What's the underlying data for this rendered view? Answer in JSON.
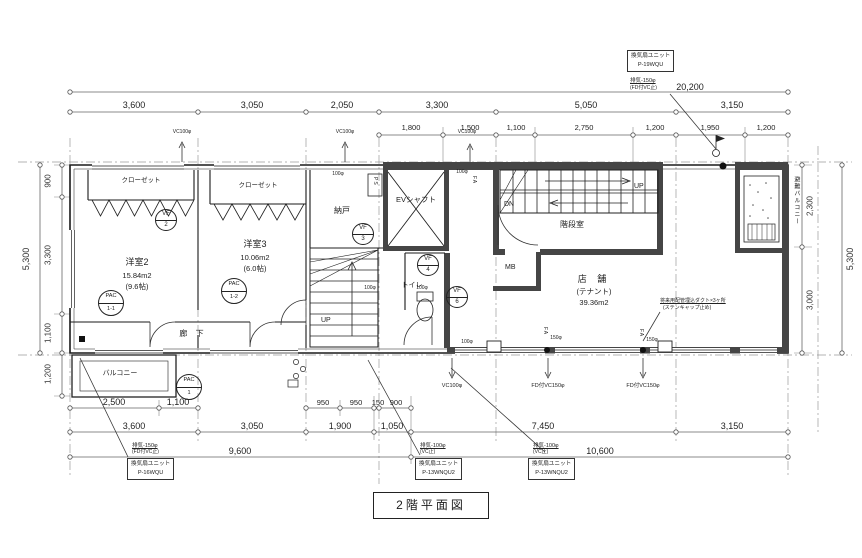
{
  "title": "2階平面図",
  "dims": {
    "top_total": "20,200",
    "top_main": [
      "3,600",
      "3,050",
      "2,050",
      "3,300",
      "5,050",
      "3,150"
    ],
    "top_sub": [
      "1,800",
      "1,500",
      "1,100",
      "2,750",
      "1,200",
      "1,950",
      "1,200"
    ],
    "left_total": "5,300",
    "left_segs": [
      "900",
      "3,300",
      "1,100"
    ],
    "left_below": "1,200",
    "right_total": "5,300",
    "right_segs": [
      "2,300",
      "3,000"
    ],
    "bottom_row1_left": [
      "2,500",
      "1,100"
    ],
    "bottom_row1_mid": [
      "950",
      "950",
      "150",
      "900"
    ],
    "bottom_row2": [
      "3,600",
      "3,050",
      "1,900",
      "1,050",
      "7,450",
      "3,150"
    ],
    "bottom_row3": [
      "9,600",
      "10,600"
    ]
  },
  "rooms": {
    "yoshitsu2": {
      "name": "洋室2",
      "area": "15.84m2",
      "tatami": "(9.6帖)"
    },
    "yoshitsu3": {
      "name": "洋室3",
      "area": "10.06m2",
      "tatami": "(6.0帖)"
    },
    "tenant": {
      "name": "店 舗",
      "sub": "(テナント)",
      "area": "39.36m2"
    },
    "nando": "納戸",
    "ev_shaft": "EVシャフト",
    "toilet": "トイレ",
    "stair_hall": "階段室",
    "corridor": "廊 下",
    "balcony": "バルコニー",
    "evac_balcony": "避難バルコニー",
    "closet1": "クローゼット",
    "closet2": "クローゼット"
  },
  "symbols": {
    "vf2": {
      "t": "VF",
      "n": "2"
    },
    "vf3": {
      "t": "VF",
      "n": "3"
    },
    "vf4": {
      "t": "VF",
      "n": "4"
    },
    "vf6": {
      "t": "VF",
      "n": "6"
    },
    "pac11": {
      "t": "PAC",
      "n": "1-1"
    },
    "pac12": {
      "t": "PAC",
      "n": "1-2"
    },
    "pac1": {
      "t": "PAC",
      "n": "1"
    },
    "mb": "MB",
    "ps": "PS",
    "up1": "UP",
    "up2": "UP",
    "dn": "DN"
  },
  "pipes": {
    "vc100_top1": "VC100φ",
    "vc100_top2": "VC100φ",
    "vc100_top3": "VC100φ",
    "vc100_bottom": "VC100φ",
    "fdvc150_1": "FD付VC150φ",
    "fdvc150_2": "FD付VC150φ",
    "d100_1": "100φ",
    "d100_2": "100φ",
    "d100_3": "100φ",
    "d100_4": "100φ",
    "d100_5": "100φ",
    "d150_1": "150φ",
    "d150_2": "150φ",
    "fa1": "FA",
    "fa2": "FA",
    "fa3": "FA"
  },
  "annotations": {
    "fan_tr": {
      "line1": "換気扇ユニット",
      "line2": "P-19WQU",
      "pipe1": "排気-150φ",
      "pipe2": "(FD付VC止)"
    },
    "fan_bl": {
      "line1": "換気扇ユニット",
      "line2": "P-16WQU",
      "pipe1": "排気-150φ",
      "pipe2": "(FD付VC止)"
    },
    "fan_bm": {
      "line1": "換気扇ユニット",
      "line2": "P-13WNQU2",
      "pipe1": "排気-100φ",
      "pipe2": "(VC止)"
    },
    "fan_br": {
      "line1": "換気扇ユニット",
      "line2": "P-13WNQU2",
      "pipe1": "排気-100φ",
      "pipe2": "(VC止)"
    },
    "tenant_note1": "将来用配管埋込ダクト×3ヶ所",
    "tenant_note2": "(ステンキャップ止め)"
  }
}
